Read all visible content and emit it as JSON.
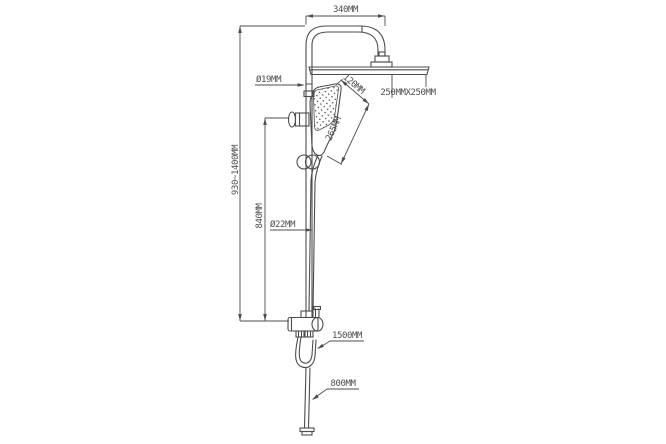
{
  "labels": {
    "arm_width": "340MM",
    "upper_pipe_diameter": "Ø19MM",
    "head_size": "250MMX250MM",
    "hand_shower_width": "120MM",
    "hand_shower_length": "265MM",
    "overall_height": "930~1400MM",
    "holder_to_mixer_height": "840MM",
    "lower_pipe_diameter": "Ø22MM",
    "shower_hose_length": "1500MM",
    "inlet_hose_length": "800MM"
  },
  "colors": {
    "line": "#4d4d4d",
    "background": "#ffffff"
  }
}
